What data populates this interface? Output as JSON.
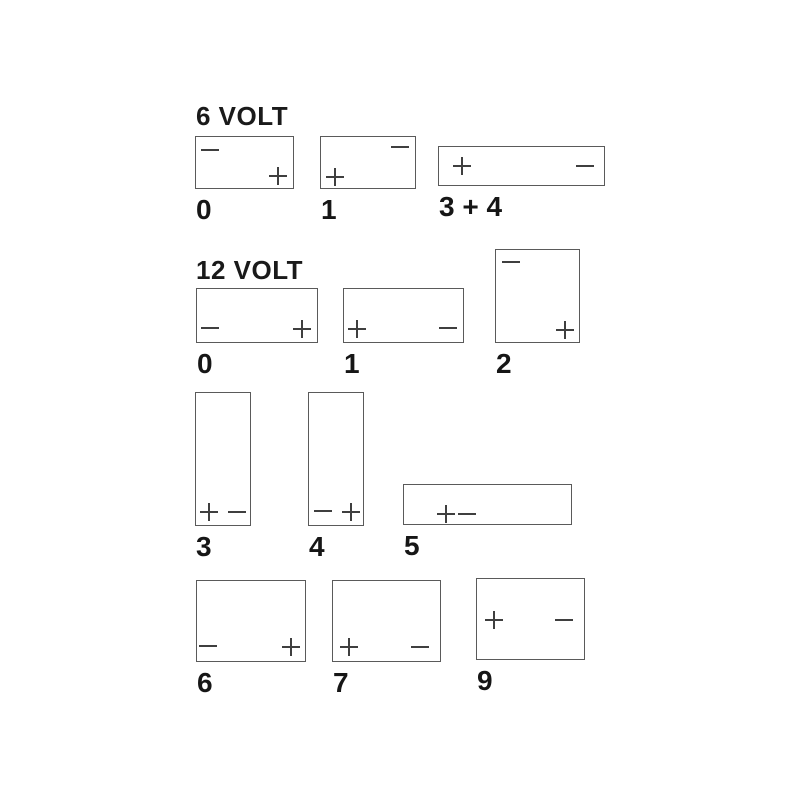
{
  "diagram": {
    "background": "#ffffff",
    "box_border_color": "#5a5a5a",
    "terminal_sign_color": "#3f3f3f",
    "label_color": "#161616",
    "plus_glyph": "+",
    "minus_glyph": "−"
  },
  "sections": [
    {
      "title": "6 VOLT",
      "x": 196,
      "y": 103
    },
    {
      "title": "12 VOLT",
      "x": 196,
      "y": 257
    }
  ],
  "batteries": [
    {
      "section": "6 VOLT",
      "label": "0",
      "x": 195,
      "y": 136,
      "w": 99,
      "h": 53,
      "terminals": [
        {
          "sign": "minus",
          "left": 5,
          "top": 4
        },
        {
          "sign": "plus",
          "right": 6,
          "bottom": 3
        }
      ]
    },
    {
      "section": "6 VOLT",
      "label": "1",
      "x": 320,
      "y": 136,
      "w": 96,
      "h": 53,
      "terminals": [
        {
          "sign": "minus",
          "right": 6,
          "top": 1
        },
        {
          "sign": "plus",
          "left": 5,
          "bottom": 2
        }
      ]
    },
    {
      "section": "6 VOLT",
      "label": "3 + 4",
      "x": 438,
      "y": 146,
      "w": 167,
      "h": 40,
      "terminals": [
        {
          "sign": "plus",
          "left": 14,
          "top": 10
        },
        {
          "sign": "minus",
          "right": 10,
          "top": 10
        }
      ]
    },
    {
      "section": "12 VOLT",
      "label": "0",
      "x": 196,
      "y": 288,
      "w": 122,
      "h": 55,
      "terminals": [
        {
          "sign": "minus",
          "left": 4,
          "bottom": 5
        },
        {
          "sign": "plus",
          "right": 6,
          "bottom": 4
        }
      ]
    },
    {
      "section": "12 VOLT",
      "label": "1",
      "x": 343,
      "y": 288,
      "w": 121,
      "h": 55,
      "terminals": [
        {
          "sign": "plus",
          "left": 4,
          "bottom": 4
        },
        {
          "sign": "minus",
          "right": 6,
          "bottom": 5
        }
      ]
    },
    {
      "section": "12 VOLT",
      "label": "2",
      "x": 495,
      "y": 249,
      "w": 85,
      "h": 94,
      "terminals": [
        {
          "sign": "minus",
          "left": 6,
          "top": 3
        },
        {
          "sign": "plus",
          "right": 5,
          "bottom": 3
        }
      ]
    },
    {
      "section": "12 VOLT",
      "label": "3",
      "x": 195,
      "y": 392,
      "w": 56,
      "h": 134,
      "terminals": [
        {
          "sign": "plus",
          "left": 4,
          "bottom": 4
        },
        {
          "sign": "minus",
          "right": 4,
          "bottom": 4
        }
      ]
    },
    {
      "section": "12 VOLT",
      "label": "4",
      "x": 308,
      "y": 392,
      "w": 56,
      "h": 134,
      "terminals": [
        {
          "sign": "minus",
          "left": 5,
          "bottom": 5
        },
        {
          "sign": "plus",
          "right": 3,
          "bottom": 4
        }
      ]
    },
    {
      "section": "12 VOLT",
      "label": "5",
      "x": 403,
      "y": 484,
      "w": 169,
      "h": 41,
      "terminals": [
        {
          "sign": "plus",
          "left": 33,
          "top": 20
        },
        {
          "sign": "minus",
          "left": 54,
          "top": 20
        }
      ]
    },
    {
      "section": "12 VOLT",
      "label": "6",
      "x": 196,
      "y": 580,
      "w": 110,
      "h": 82,
      "terminals": [
        {
          "sign": "minus",
          "left": 2,
          "bottom": 6
        },
        {
          "sign": "plus",
          "right": 5,
          "bottom": 5
        }
      ]
    },
    {
      "section": "12 VOLT",
      "label": "7",
      "x": 332,
      "y": 580,
      "w": 109,
      "h": 82,
      "terminals": [
        {
          "sign": "plus",
          "left": 7,
          "bottom": 5
        },
        {
          "sign": "minus",
          "right": 11,
          "bottom": 5
        }
      ]
    },
    {
      "section": "12 VOLT",
      "label": "9",
      "x": 476,
      "y": 578,
      "w": 109,
      "h": 82,
      "terminals": [
        {
          "sign": "plus",
          "left": 8,
          "top": 32
        },
        {
          "sign": "minus",
          "right": 11,
          "top": 32
        }
      ]
    }
  ]
}
